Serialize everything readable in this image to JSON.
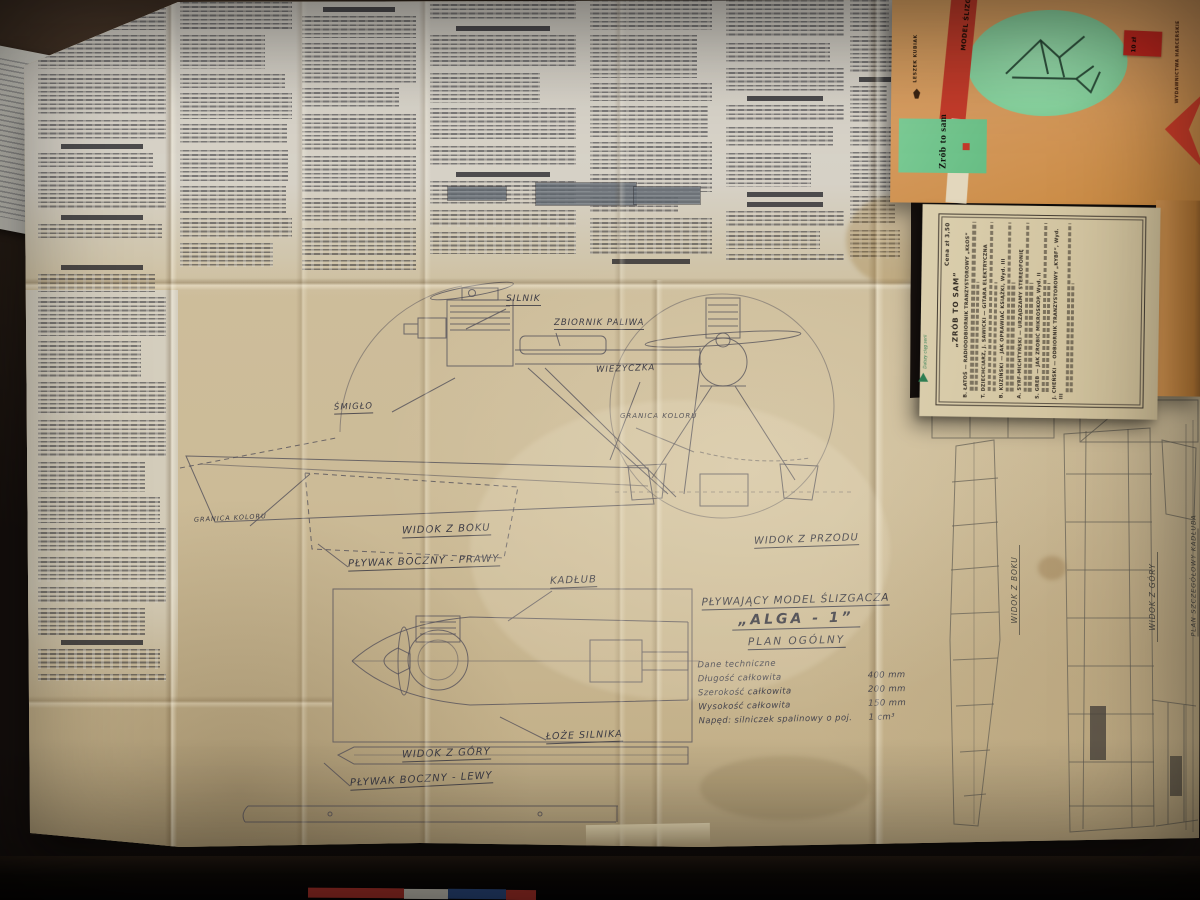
{
  "plan": {
    "labels": {
      "silnik": "SILNIK",
      "zbiornik_paliwa": "ZBIORNIK PALIWA",
      "wiezyczka": "WIEŻYCZKA",
      "smiglo": "ŚMIGŁO",
      "granica_koloru_right": "GRANICA KOLORU",
      "granica_koloru_left": "GRANICA KOLORU",
      "widok_z_boku": "WIDOK Z BOKU",
      "plywak_boczny_prawy": "PŁYWAK BOCZNY - PRAWY",
      "kadlub": "KADŁUB",
      "widok_z_przodu": "WIDOK Z PRZODU",
      "loze_silnika": "ŁOŻE SILNIKA",
      "widok_z_gory": "WIDOK Z GÓRY",
      "plywak_boczny_lewy": "PŁYWAK BOCZNY - LEWY"
    },
    "title_block": {
      "line1": "PŁYWAJĄCY MODEL ŚLIZGACZA",
      "line2": "„ALGA - 1”",
      "line3": "PLAN OGÓLNY"
    },
    "tech_data": {
      "heading": "Dane techniczne",
      "rows": [
        {
          "label": "Długość całkowita",
          "value": "400 mm"
        },
        {
          "label": "Szerokość całkowita",
          "value": "200 mm"
        },
        {
          "label": "Wysokość całkowita",
          "value": "150 mm"
        },
        {
          "label": "Napęd: silniczek spalinowy o poj.",
          "value": "1 cm³"
        }
      ]
    },
    "detail_labels": {
      "side": "WIDOK Z BOKU",
      "top": "WIDOK Z GÓRY",
      "hull_plan": "PLAN SZCZEGÓŁOWY KADŁUBA"
    }
  },
  "booklet": {
    "series_logo": "Zrób to sam",
    "author": "LESZEK KUBIAK",
    "cover_title": "MODEL ŚLIZGACZA „ALGA-1”",
    "publisher_edge": "WYDAWNICTWA HARCERSKIE",
    "price_sticker": "10 zł",
    "back_cover": {
      "price": "Cena zł 3,50",
      "heading": "„ZRÓB TO SAM”",
      "series_note": "Dalszy ciąg serii",
      "items": [
        {
          "title": "B. ŁATOŚ — RADIOODBIORNIK TRANZYSTOROWY „KŁOS”"
        },
        {
          "title": "T. DZIECHCIARZ, J. SAWICKI — GITARA ELEKTRYCZNA"
        },
        {
          "title": "B. KUZIŃSKI — JAK OPRAWIAĆ KSIĄŻKI, Wyd. III"
        },
        {
          "title": "A. SYRF-MICHTYŃSKI — URZĄDZAMY STEREOFONIĘ"
        },
        {
          "title": "S. GREB — JAK ZROBIĆ MIKROSKOP, Wyd. II"
        },
        {
          "title": "J. CHEŃSKI — ODBIORNIK TRANZYSTOROWY „KYBF”, Wyd. III"
        }
      ]
    }
  },
  "colors": {
    "cover_orange": "#d59a5e",
    "ellipse_green": "#8bd4a2",
    "logo_green": "#72c28e",
    "band_red": "#c43a2b",
    "paper_tan": "#cbbb97",
    "paper_gray": "#d7d2c7",
    "table_dark": "#241b12"
  }
}
